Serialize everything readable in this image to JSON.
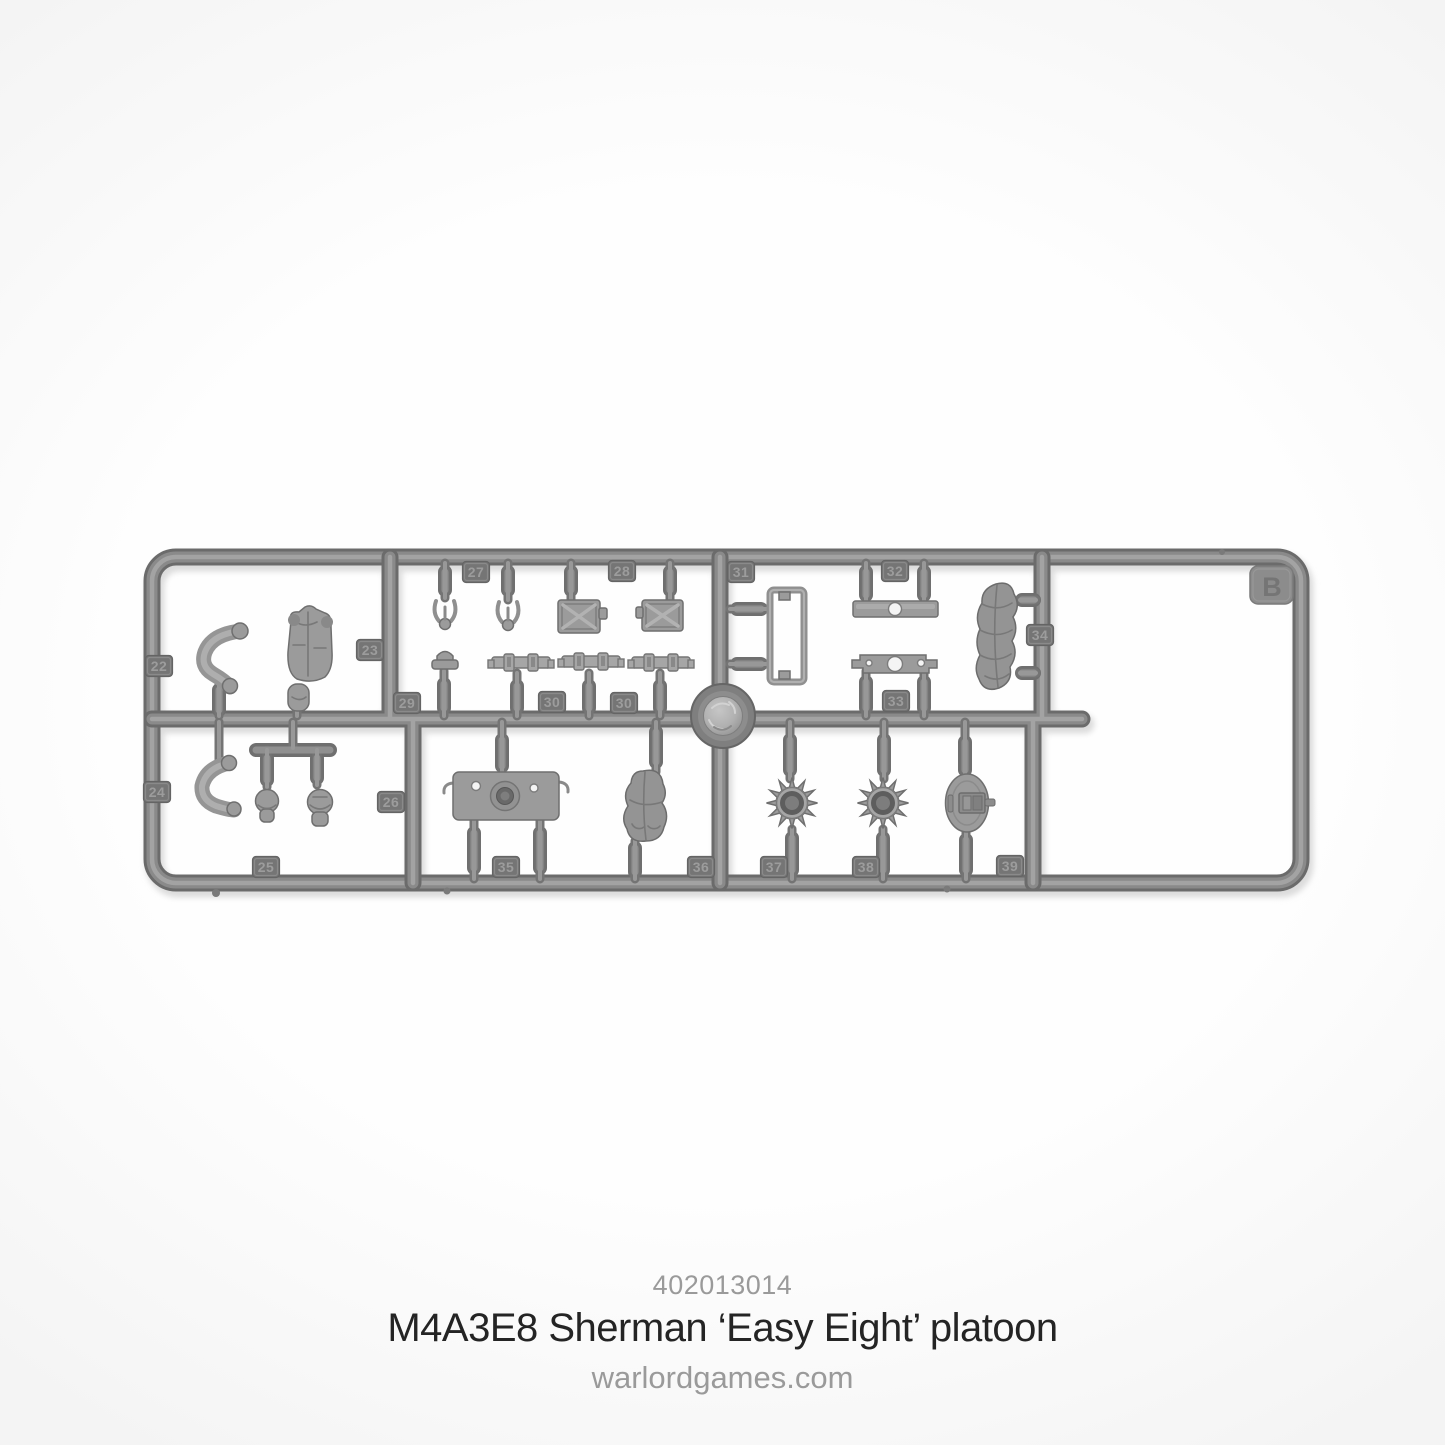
{
  "product": {
    "sku": "402013014",
    "title": "M4A3E8 Sherman ‘Easy Eight’ platoon",
    "website": "warlordgames.com"
  },
  "sprue": {
    "letter": "B",
    "material_color": "#8a8a8a",
    "tag_plate_color": "#757575",
    "tag_text_color": "#9c9c9c",
    "background_color": "#fefefe",
    "part_tags": [
      {
        "label": "22",
        "x": 159,
        "y": 666
      },
      {
        "label": "23",
        "x": 370,
        "y": 650
      },
      {
        "label": "24",
        "x": 157,
        "y": 792
      },
      {
        "label": "25",
        "x": 266,
        "y": 867
      },
      {
        "label": "26",
        "x": 391,
        "y": 802
      },
      {
        "label": "27",
        "x": 476,
        "y": 572
      },
      {
        "label": "28",
        "x": 622,
        "y": 571
      },
      {
        "label": "29",
        "x": 407,
        "y": 703
      },
      {
        "label": "30",
        "x": 552,
        "y": 702
      },
      {
        "label": "30",
        "x": 624,
        "y": 703
      },
      {
        "label": "31",
        "x": 741,
        "y": 572
      },
      {
        "label": "32",
        "x": 895,
        "y": 571
      },
      {
        "label": "33",
        "x": 896,
        "y": 701
      },
      {
        "label": "34",
        "x": 1040,
        "y": 635
      },
      {
        "label": "35",
        "x": 506,
        "y": 867
      },
      {
        "label": "36",
        "x": 701,
        "y": 867
      },
      {
        "label": "37",
        "x": 774,
        "y": 867
      },
      {
        "label": "38",
        "x": 866,
        "y": 867
      },
      {
        "label": "39",
        "x": 1010,
        "y": 866
      }
    ]
  }
}
